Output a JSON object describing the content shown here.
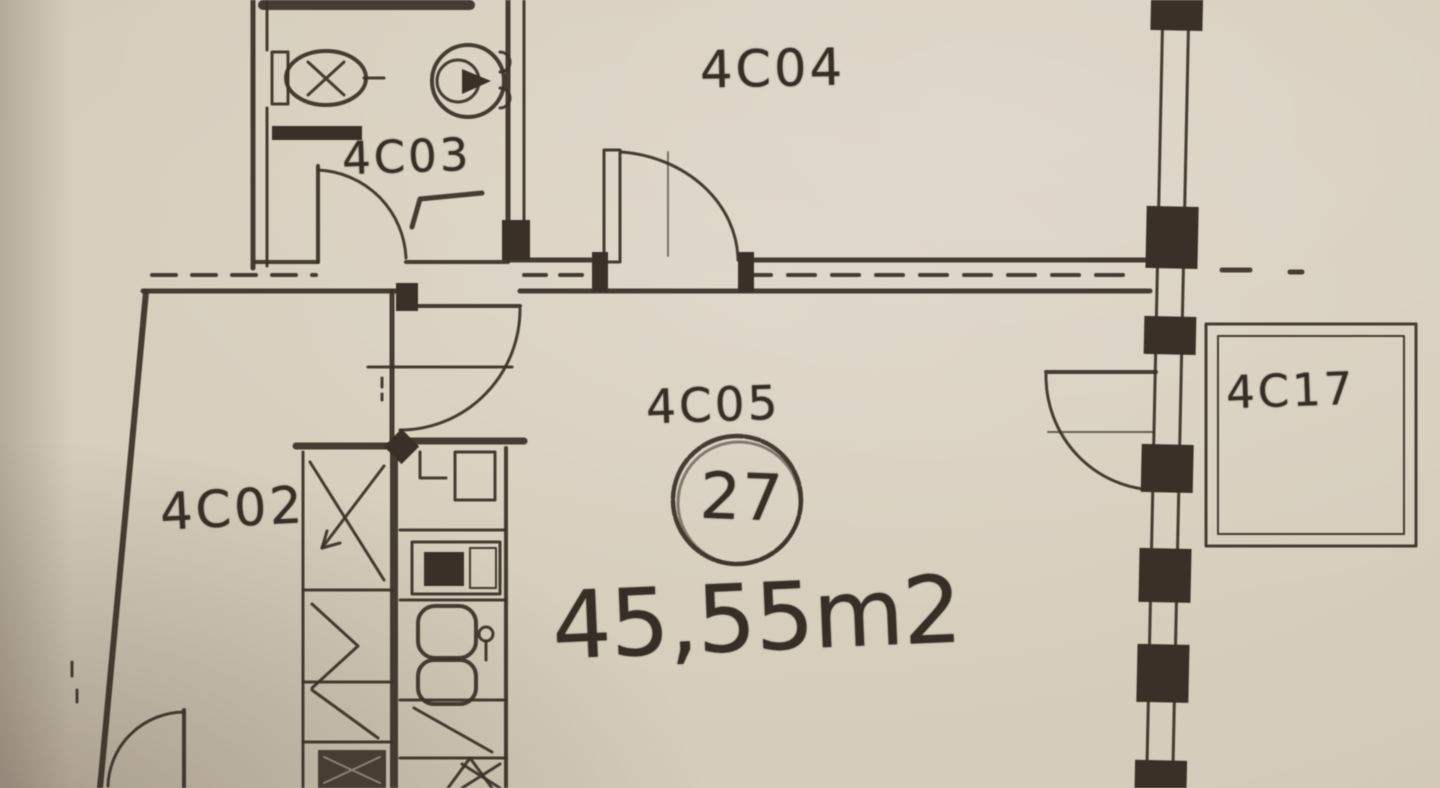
{
  "document": {
    "kind": "scanned apartment floor plan",
    "paper_color": "#d5cbba",
    "ink_color": "#3a3027"
  },
  "rooms": {
    "bathroom": {
      "label": "4C03"
    },
    "room_top": {
      "label": "4C04"
    },
    "living": {
      "label": "4C05"
    },
    "room_left": {
      "label": "4C02"
    },
    "balcony": {
      "label": "4C17"
    }
  },
  "unit": {
    "number": "27",
    "area": "45,55m2"
  },
  "icons": {
    "sink": "sink-icon",
    "toilet": "toilet-icon",
    "stove": "stove-icon",
    "kitchen_sink": "kitchen-sink-icon",
    "wardrobe": "wardrobe-cross-icon",
    "door": "door-swing-arc",
    "window_wall": "window-wall",
    "balcony": "balcony-outline"
  }
}
